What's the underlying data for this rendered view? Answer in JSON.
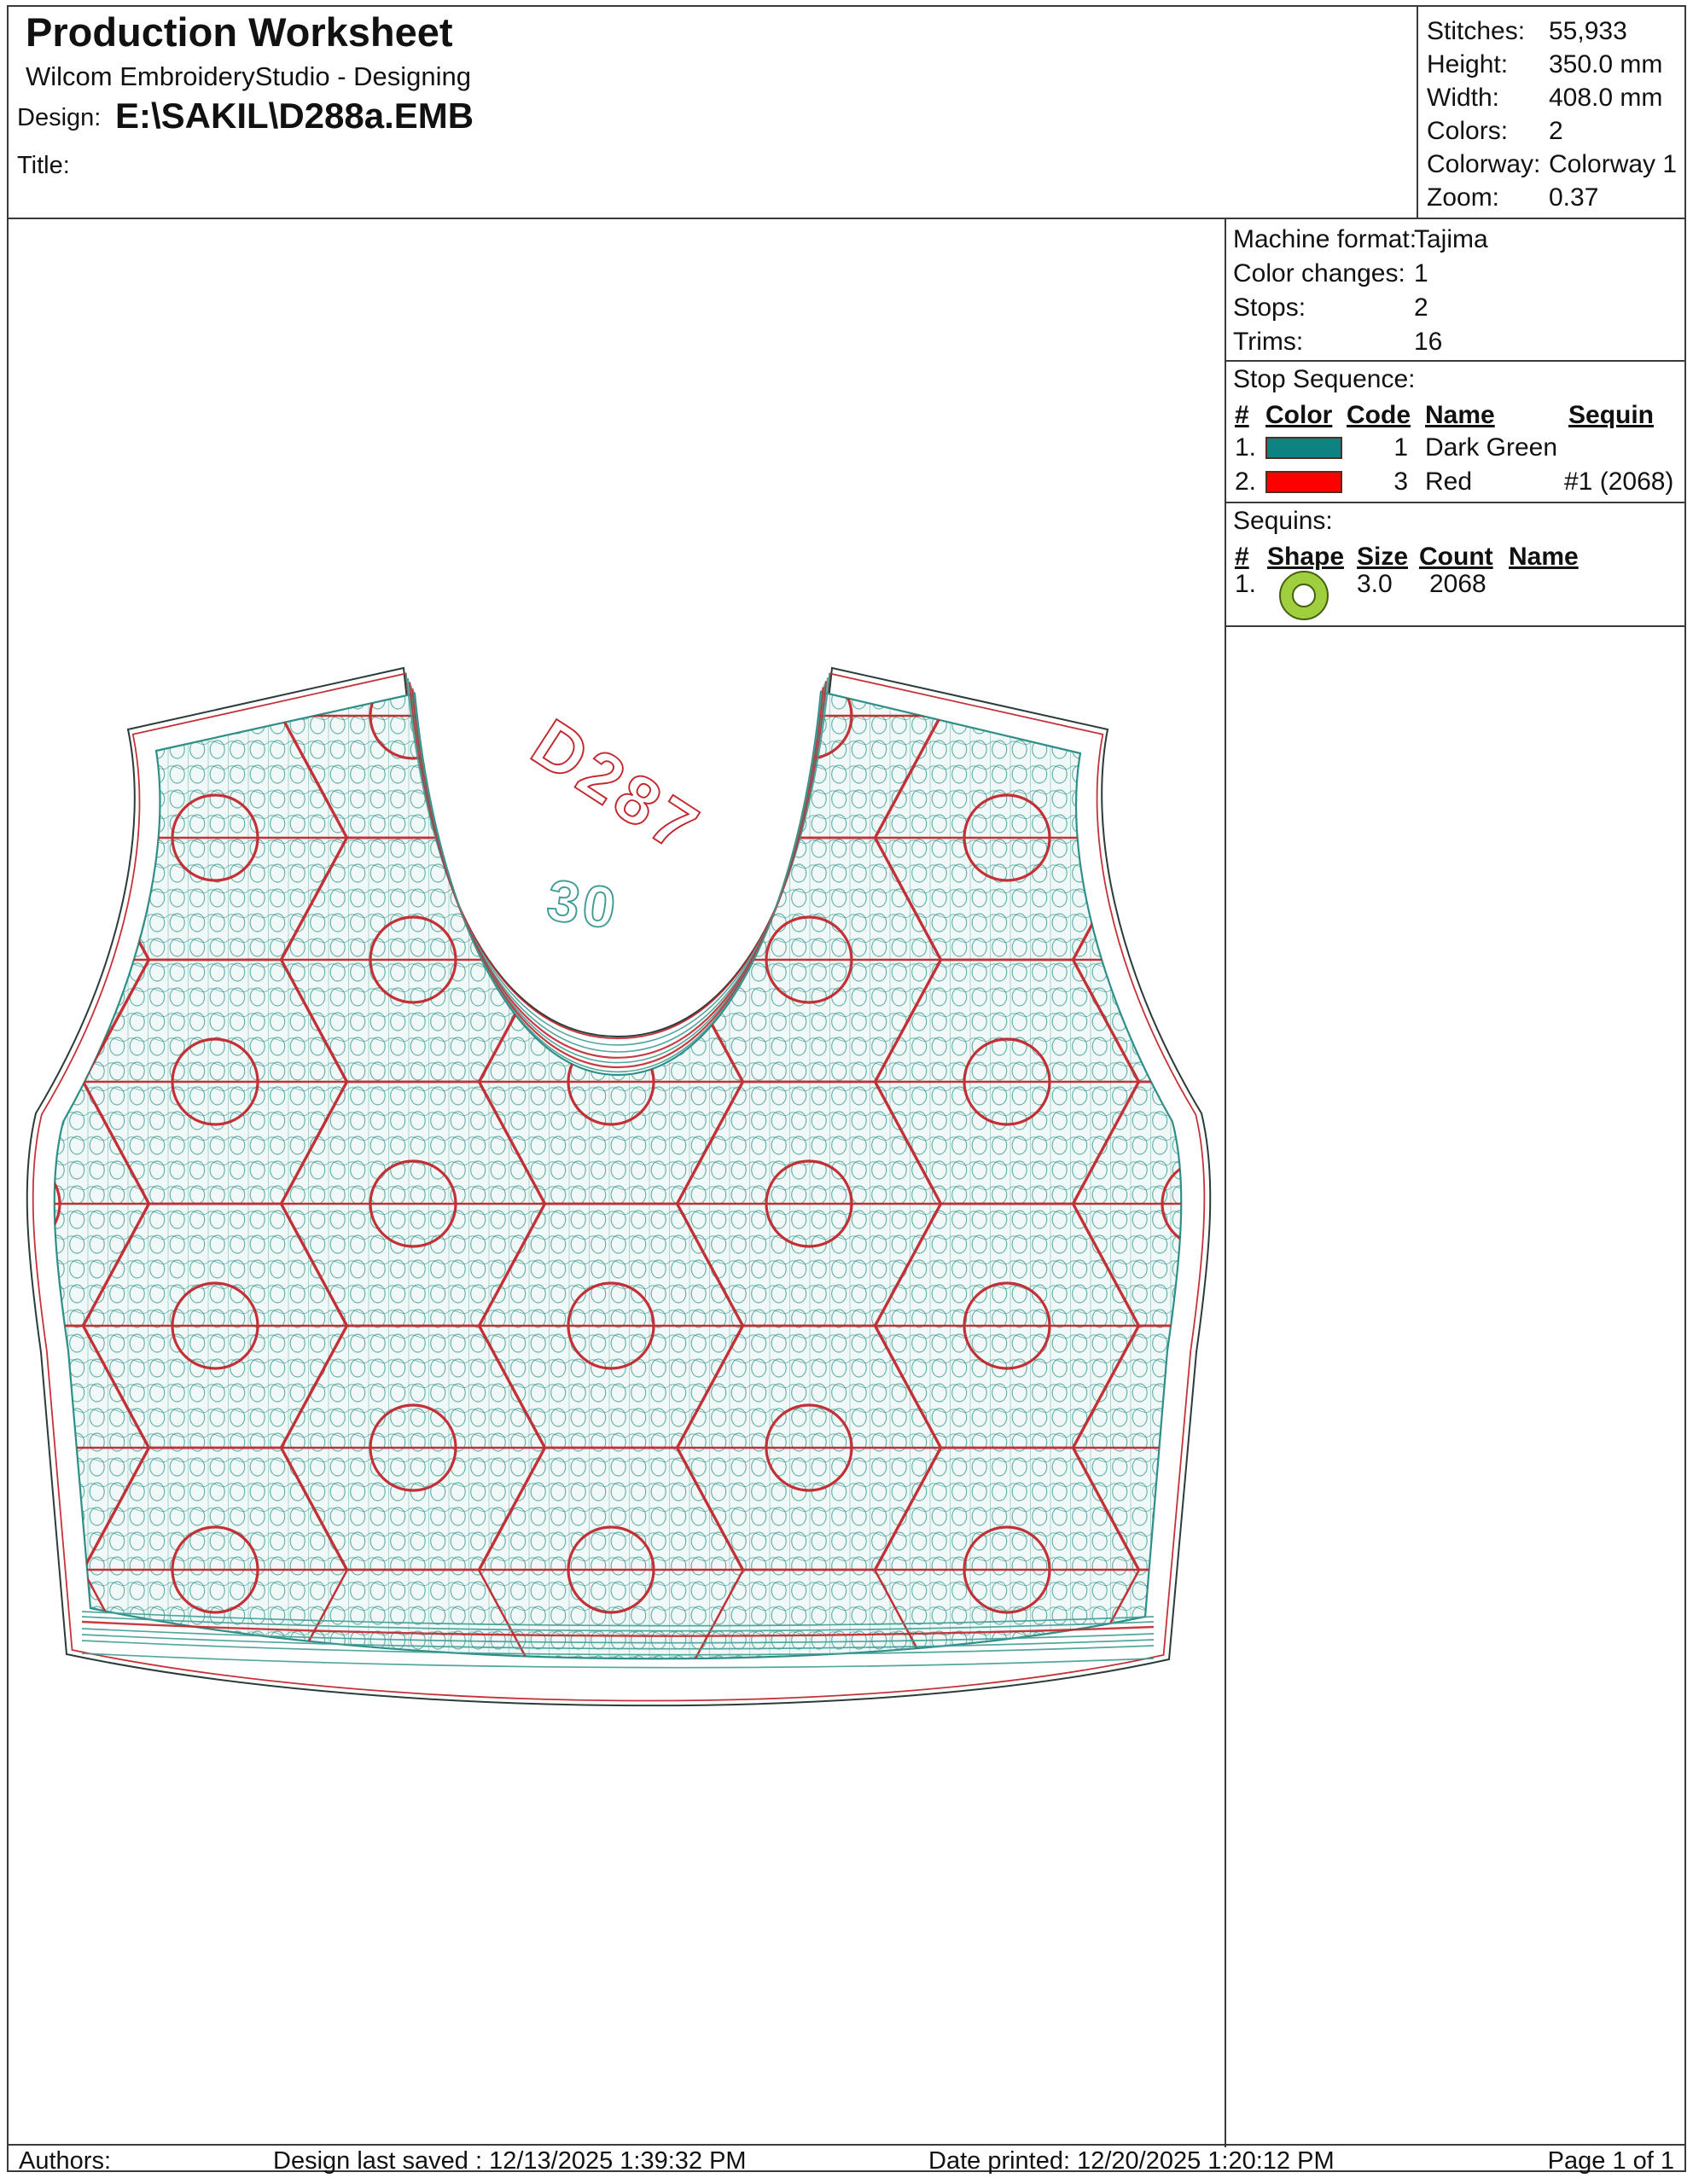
{
  "header": {
    "title": "Production Worksheet",
    "subtitle": "Wilcom EmbroideryStudio - Designing",
    "design_label": "Design:",
    "design_value": "E:\\SAKIL\\D288a.EMB",
    "title_label": "Title:"
  },
  "stats": {
    "rows": [
      {
        "label": "Stitches:",
        "value": "55,933"
      },
      {
        "label": "Height:",
        "value": "350.0 mm"
      },
      {
        "label": "Width:",
        "value": "408.0 mm"
      },
      {
        "label": "Colors:",
        "value": "2"
      },
      {
        "label": "Colorway:",
        "value": "Colorway 1"
      },
      {
        "label": "Zoom:",
        "value": "0.37"
      }
    ]
  },
  "machine": {
    "rows": [
      {
        "label": "Machine format:",
        "value": "Tajima"
      },
      {
        "label": "Color changes:",
        "value": "1"
      },
      {
        "label": "Stops:",
        "value": "2"
      },
      {
        "label": "Trims:",
        "value": "16"
      }
    ]
  },
  "stop_sequence": {
    "title": "Stop Sequence:",
    "headers": [
      "#",
      "Color",
      "Code",
      "Name",
      "Sequin"
    ],
    "rows": [
      {
        "num": "1.",
        "color": "#0E8282",
        "code": "1",
        "name": "Dark Green",
        "sequin": ""
      },
      {
        "num": "2.",
        "color": "#FE0000",
        "code": "3",
        "name": "Red",
        "sequin": "#1 (2068)"
      }
    ]
  },
  "sequins": {
    "title": "Sequins:",
    "headers": [
      "#",
      "Shape",
      "Size",
      "Count",
      "Name"
    ],
    "rows": [
      {
        "num": "1.",
        "shape": "donut-sequin",
        "fill": "#9FCE3E",
        "edge": "#44600f",
        "size": "3.0",
        "count": "2068",
        "name": ""
      }
    ]
  },
  "design": {
    "label_main": "D287",
    "label_size": "30",
    "thread_teal": "#3F9C94",
    "thread_red": "#C1272D",
    "outline_color": "#2A3C3A",
    "fill_wash": "#F1F9F8",
    "edge_teal": "#2E8F88"
  },
  "footer": {
    "authors_label": "Authors:",
    "last_saved": "Design last saved : 12/13/2025 1:39:32 PM",
    "date_printed": "Date printed: 12/20/2025 1:20:12 PM",
    "page": "Page 1 of 1"
  }
}
